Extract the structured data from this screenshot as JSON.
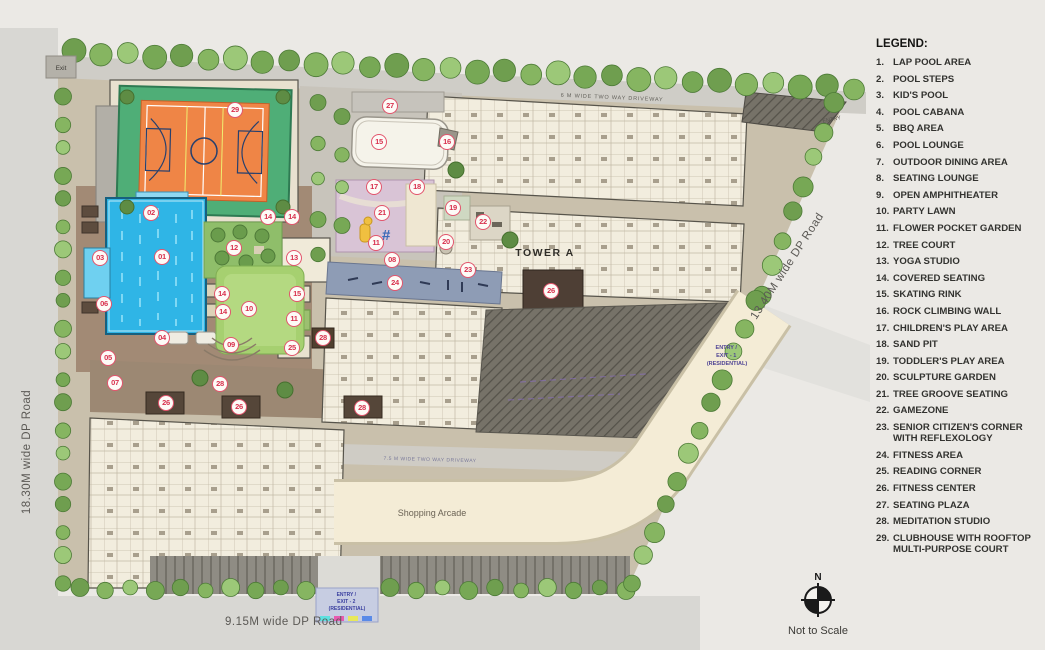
{
  "plan": {
    "roads": {
      "left": "18.30M wide DP Road",
      "bottom": "9.15M wide DP Road",
      "right": "13.40M wide DP Road"
    },
    "driveway_top": "6 M WIDE TWO WAY DRIVEWAY",
    "driveway_inner": "7.5 M WIDE TWO WAY DRIVEWAY",
    "tower_label": "TOWER A",
    "shopping_arcade": "Shopping Arcade",
    "exit_top": "Exit",
    "entry_top": "ENTRY",
    "entry_exit_1": [
      "ENTRY /",
      "EXIT - 1",
      "(RESIDENTIAL)"
    ],
    "entry_exit_2": [
      "ENTRY /",
      "EXIT - 2",
      "(RESIDENTIAL)"
    ],
    "markers": [
      {
        "n": "29",
        "x": 235,
        "y": 110
      },
      {
        "n": "27",
        "x": 390,
        "y": 106
      },
      {
        "n": "15",
        "x": 379,
        "y": 142
      },
      {
        "n": "16",
        "x": 447,
        "y": 142
      },
      {
        "n": "02",
        "x": 151,
        "y": 213
      },
      {
        "n": "14",
        "x": 268,
        "y": 217
      },
      {
        "n": "14",
        "x": 292,
        "y": 217
      },
      {
        "n": "17",
        "x": 374,
        "y": 187
      },
      {
        "n": "18",
        "x": 417,
        "y": 187
      },
      {
        "n": "19",
        "x": 453,
        "y": 208
      },
      {
        "n": "21",
        "x": 382,
        "y": 213
      },
      {
        "n": "22",
        "x": 483,
        "y": 222
      },
      {
        "n": "12",
        "x": 234,
        "y": 248
      },
      {
        "n": "01",
        "x": 162,
        "y": 257
      },
      {
        "n": "03",
        "x": 100,
        "y": 258
      },
      {
        "n": "13",
        "x": 294,
        "y": 258
      },
      {
        "n": "11",
        "x": 376,
        "y": 243
      },
      {
        "n": "20",
        "x": 446,
        "y": 242
      },
      {
        "n": "08",
        "x": 392,
        "y": 260
      },
      {
        "n": "23",
        "x": 468,
        "y": 270
      },
      {
        "n": "24",
        "x": 395,
        "y": 283
      },
      {
        "n": "26",
        "x": 551,
        "y": 291
      },
      {
        "n": "14",
        "x": 222,
        "y": 294
      },
      {
        "n": "15",
        "x": 297,
        "y": 294
      },
      {
        "n": "06",
        "x": 104,
        "y": 304
      },
      {
        "n": "10",
        "x": 249,
        "y": 309
      },
      {
        "n": "14",
        "x": 223,
        "y": 312
      },
      {
        "n": "11",
        "x": 294,
        "y": 319
      },
      {
        "n": "04",
        "x": 162,
        "y": 338
      },
      {
        "n": "28",
        "x": 323,
        "y": 338
      },
      {
        "n": "09",
        "x": 231,
        "y": 345
      },
      {
        "n": "25",
        "x": 292,
        "y": 348
      },
      {
        "n": "05",
        "x": 108,
        "y": 358
      },
      {
        "n": "07",
        "x": 115,
        "y": 383
      },
      {
        "n": "28",
        "x": 220,
        "y": 384
      },
      {
        "n": "26",
        "x": 166,
        "y": 403
      },
      {
        "n": "26",
        "x": 239,
        "y": 407
      },
      {
        "n": "28",
        "x": 362,
        "y": 408
      }
    ]
  },
  "legend": {
    "title": "LEGEND:",
    "items": [
      "LAP POOL AREA",
      "POOL STEPS",
      "KID'S POOL",
      "POOL CABANA",
      "BBQ AREA",
      "POOL LOUNGE",
      "OUTDOOR DINING AREA",
      "SEATING LOUNGE",
      "OPEN AMPHITHEATER",
      "PARTY LAWN",
      "FLOWER POCKET GARDEN",
      "TREE COURT",
      "YOGA STUDIO",
      "COVERED SEATING",
      "SKATING RINK",
      "ROCK CLIMBING WALL",
      "CHILDREN'S PLAY AREA",
      "SAND PIT",
      "TODDLER'S PLAY AREA",
      "SCULPTURE GARDEN",
      "TREE GROOVE SEATING",
      "GAMEZONE",
      "SENIOR CITIZEN'S CORNER WITH REFLEXOLOGY",
      "FITNESS AREA",
      "READING CORNER",
      "FITNESS CENTER",
      "SEATING PLAZA",
      "MEDITATION STUDIO",
      "CLUBHOUSE WITH ROOFTOP MULTI-PURPOSE COURT"
    ]
  },
  "compass": {
    "north": "N",
    "note": "Not to Scale"
  },
  "colors": {
    "marker_red": "#d8304d",
    "pool_blue": "#2fb5e6",
    "court_orange": "#ef8546",
    "court_green": "#4fae77",
    "lawn_green": "#a6d070",
    "tree_green": "#79a855"
  }
}
